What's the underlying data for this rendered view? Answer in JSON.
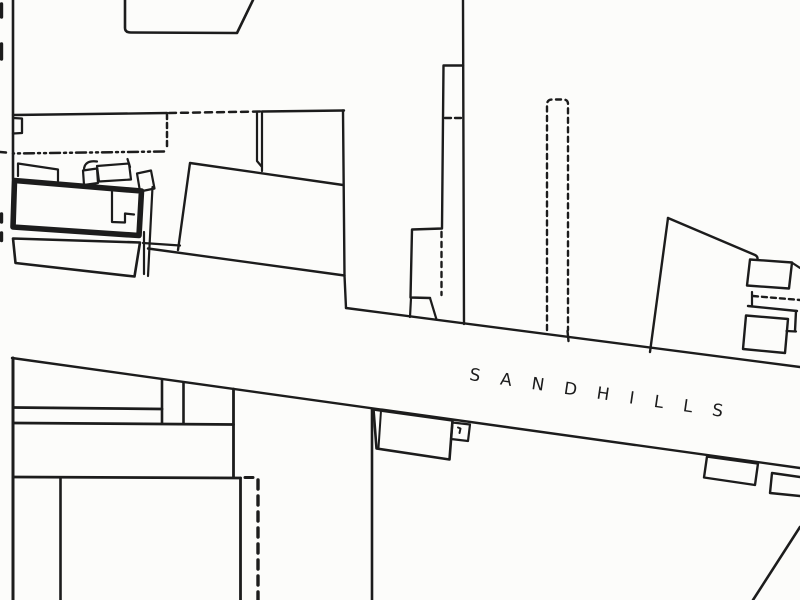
{
  "map": {
    "street_label": "SANDHILLS",
    "colors": {
      "ink": "#1c1c1c",
      "paper": "#fcfcfa",
      "highlight-red": "#bd241c"
    }
  }
}
